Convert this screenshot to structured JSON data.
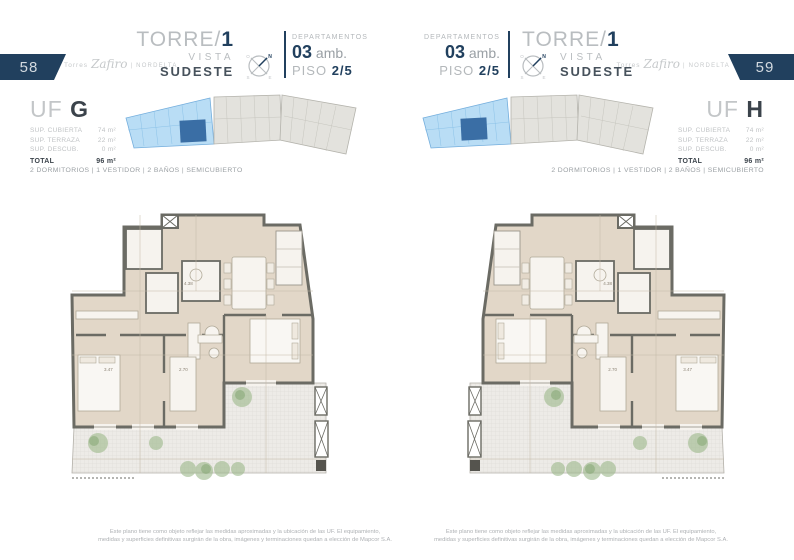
{
  "pages": [
    {
      "page_number": "58",
      "brand": {
        "torres": "Torres",
        "zafiro": "Zafiro",
        "nordelta": "| NORDELTA"
      },
      "title": {
        "torre": "TORRE/",
        "number": "1",
        "vista": "VISTA",
        "orientation": "SUDESTE"
      },
      "dept": {
        "label": "DEPARTAMENTOS",
        "number": "03",
        "amb": "amb.",
        "piso": "PISO",
        "piso_value": "2/5"
      },
      "unit": {
        "uf": "UF",
        "letter": "G",
        "rows": [
          {
            "label": "SUP. CUBIERTA",
            "value": "74 m²"
          },
          {
            "label": "SUP. TERRAZA",
            "value": "22 m²"
          },
          {
            "label": "SUP. DESCUB.",
            "value": "0 m²"
          }
        ],
        "total": {
          "label": "TOTAL",
          "value": "96 m²"
        }
      },
      "amenities": "2 DORMITORIOS | 1 VESTIDOR | 2 BAÑOS | SEMICUBIERTO",
      "plan_dims": {
        "a": "3.47",
        "b": "2.70",
        "c": "4.38"
      },
      "disclaimer": {
        "line1": "Este plano tiene como objeto reflejar las medidas aproximadas y la ubicación de las UF. El equipamiento,",
        "line2": "medidas y superficies definitivas surgirán de la obra, imágenes y terminaciones quedan a elección de Mapcor S.A."
      }
    },
    {
      "page_number": "59",
      "brand": {
        "torres": "Torres",
        "zafiro": "Zafiro",
        "nordelta": "| NORDELTA"
      },
      "title": {
        "torre": "TORRE/",
        "number": "1",
        "vista": "VISTA",
        "orientation": "SUDESTE"
      },
      "dept": {
        "label": "DEPARTAMENTOS",
        "number": "03",
        "amb": "amb.",
        "piso": "PISO",
        "piso_value": "2/5"
      },
      "unit": {
        "uf": "UF",
        "letter": "H",
        "rows": [
          {
            "label": "SUP. CUBIERTA",
            "value": "74 m²"
          },
          {
            "label": "SUP. TERRAZA",
            "value": "22 m²"
          },
          {
            "label": "SUP. DESCUB.",
            "value": "0 m²"
          }
        ],
        "total": {
          "label": "TOTAL",
          "value": "96 m²"
        }
      },
      "amenities": "2 DORMITORIOS | 1 VESTIDOR | 2 BAÑOS | SEMICUBIERTO",
      "plan_dims": {
        "a": "3.47",
        "b": "2.70",
        "c": "4.38"
      },
      "disclaimer": {
        "line1": "Este plano tiene como objeto reflejar las medidas aproximadas y la ubicación de las UF. El equipamiento,",
        "line2": "medidas y superficies definitivas surgirán de la obra, imágenes y terminaciones quedan a elección de Mapcor S.A."
      }
    }
  ],
  "compass": {
    "n": "N",
    "e": "E",
    "s": "S",
    "o": "O"
  },
  "colors": {
    "navy": "#21405e",
    "unit_highlight": "#3a6ea5",
    "keyplan_blue": "#b9ddf5",
    "floor_beige": "#e2d7c8",
    "wall_gray": "#6b6b64"
  }
}
